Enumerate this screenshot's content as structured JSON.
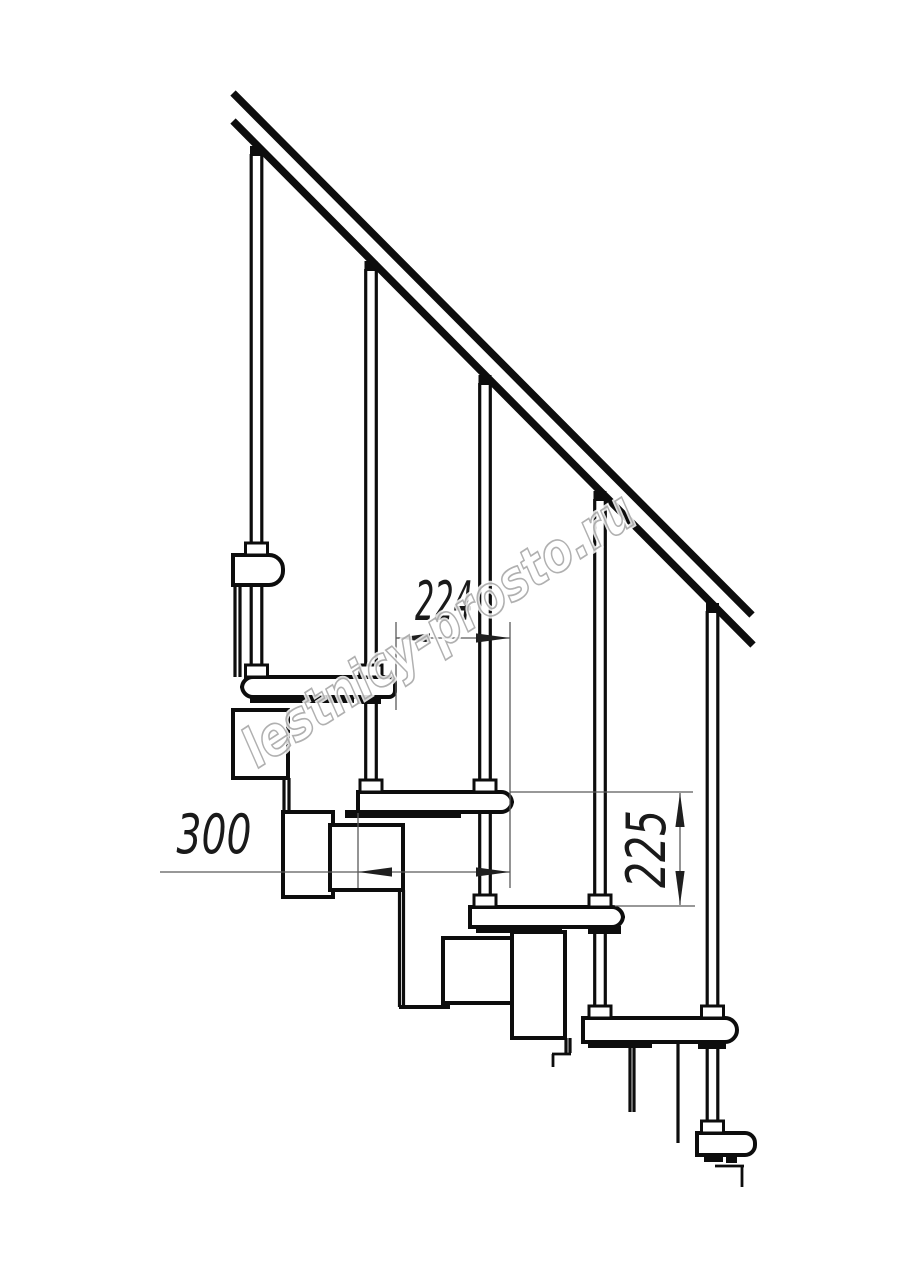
{
  "meta": {
    "type": "staircase-side-view-technical-drawing",
    "background": "#ffffff",
    "width": 914,
    "height": 1280
  },
  "colors": {
    "line": "#0d0d0d",
    "thin": "#5a5a5a",
    "arrow": "#1f1f1f",
    "dim_text": "#1a1a1a",
    "watermark_stroke": "#a8a8a8",
    "fill": "#ffffff"
  },
  "watermark": {
    "text": "lestnicy-prosto.ru"
  },
  "dimensions": {
    "d224": {
      "label": "224",
      "ext_lines": [
        [
          396,
          622,
          396,
          710
        ],
        [
          510,
          622,
          510,
          888
        ]
      ],
      "dim_line": [
        396,
        638,
        510,
        638
      ],
      "arrows": [
        [
          396,
          638,
          "left"
        ],
        [
          510,
          638,
          "right"
        ]
      ]
    },
    "d300": {
      "label": "300",
      "ext_lines": [
        [
          358,
          813,
          358,
          888
        ]
      ],
      "dim_line": [
        160,
        872,
        510,
        872
      ],
      "arrows": [
        [
          358,
          872,
          "left"
        ],
        [
          510,
          872,
          "right"
        ]
      ]
    },
    "d225": {
      "label": "225",
      "ext_lines": [
        [
          510,
          792,
          693,
          792
        ],
        [
          615,
          906,
          695,
          906
        ]
      ],
      "dim_line": [
        680,
        793,
        680,
        905
      ],
      "arrows": [
        [
          680,
          793,
          "up"
        ],
        [
          680,
          905,
          "down"
        ]
      ]
    }
  },
  "drawing": {
    "handrail_lines": [
      [
        233,
        93,
        752,
        615
      ],
      [
        233,
        121,
        753,
        645
      ]
    ],
    "handrail_width": 7.5,
    "leg_lines": [
      [
        235,
        585,
        235,
        677
      ],
      [
        240,
        585,
        240,
        677
      ],
      [
        284,
        778,
        284,
        813
      ],
      [
        289,
        778,
        289,
        813
      ],
      [
        399.5,
        890,
        399.5,
        1007
      ],
      [
        403.5,
        890,
        403.5,
        1007
      ],
      [
        566,
        1038,
        566,
        1053
      ],
      [
        570,
        1038,
        570,
        1053
      ],
      [
        630,
        1042,
        630,
        1112
      ],
      [
        634,
        1042,
        634,
        1112
      ],
      [
        678,
        1042,
        678,
        1143
      ]
    ],
    "hook_lines": [
      [
        552,
        1054,
        571,
        1054
      ],
      [
        553,
        1054,
        553,
        1067
      ],
      [
        715,
        1166,
        744,
        1166
      ],
      [
        742,
        1166,
        742,
        1187
      ]
    ],
    "shelf_lines": [
      [
        399,
        1007,
        450,
        1007
      ]
    ],
    "module_boxes": [
      [
        233,
        710,
        55,
        68
      ],
      [
        283,
        812,
        50,
        85
      ],
      [
        330,
        825,
        73,
        65
      ],
      [
        443,
        938,
        74,
        65
      ],
      [
        512,
        932,
        53,
        106
      ]
    ],
    "treads": [
      [
        233,
        555,
        50,
        30,
        0,
        14
      ],
      [
        242,
        677,
        153,
        20,
        11,
        6
      ],
      [
        358,
        792,
        154,
        20,
        0,
        11
      ],
      [
        470,
        907,
        153,
        20,
        0,
        11
      ],
      [
        583,
        1018,
        154,
        24,
        0,
        12
      ],
      [
        697,
        1133,
        58,
        22,
        0,
        10
      ]
    ],
    "clamp_strips": [
      [
        250,
        696,
        104,
        7
      ],
      [
        357,
        696,
        24,
        8
      ],
      [
        345,
        810,
        116,
        8
      ],
      [
        476,
        926,
        86,
        7
      ],
      [
        588,
        926,
        33,
        8
      ],
      [
        588,
        1041,
        64,
        7
      ],
      [
        698,
        1041,
        28,
        8
      ],
      [
        704,
        1154,
        19,
        8
      ],
      [
        726,
        1154,
        11,
        9
      ]
    ],
    "balusters": [
      {
        "cx": 256.5,
        "cap_y": 146,
        "bottom": 677,
        "bands": [
          555,
          677
        ]
      },
      {
        "cx": 371,
        "cap_y": 261,
        "bottom": 792,
        "bands": [
          677,
          792
        ]
      },
      {
        "cx": 485,
        "cap_y": 375,
        "bottom": 907,
        "bands": [
          792,
          907
        ]
      },
      {
        "cx": 600,
        "cap_y": 491,
        "bottom": 1018,
        "bands": [
          907,
          1018
        ]
      },
      {
        "cx": 712.5,
        "cap_y": 603,
        "bottom": 1133,
        "bands": [
          1018,
          1133
        ]
      }
    ]
  }
}
